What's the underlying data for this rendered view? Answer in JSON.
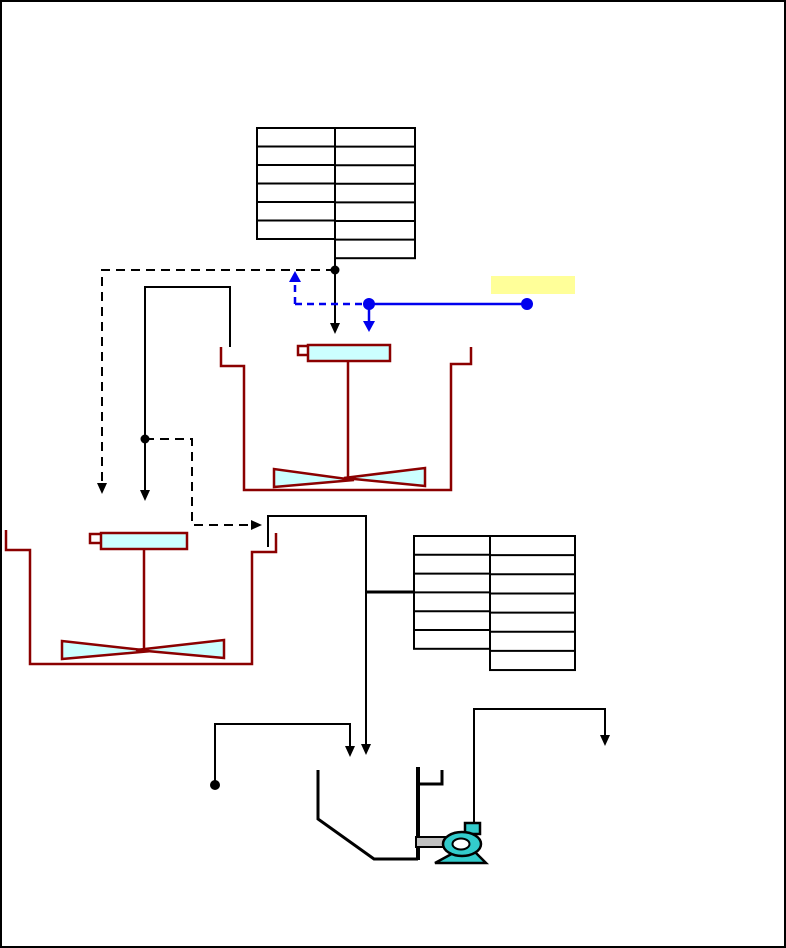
{
  "diagram": {
    "kind": "process-flow-diagram",
    "background": "#FFFFFF",
    "frame_color": "#000000"
  },
  "colors": {
    "line": "#000000",
    "tank_outline": "#8B0000",
    "equipment_fill": "#CCFFFF",
    "pump_fill": "#33CCCC",
    "pipe_gray": "#C0C0C0",
    "signal_blue": "#0000EE",
    "highlight_yellow": "#FFFF99",
    "background": "#FFFFFF"
  },
  "tables": {
    "top_table": {
      "columns": [
        {
          "x": 255,
          "y": 126,
          "width": 78,
          "row_height": 18.5,
          "rows": 6
        },
        {
          "x": 333,
          "y": 126,
          "width": 80,
          "row_height": 18.6,
          "rows": 7
        }
      ],
      "cell_text": ""
    },
    "right_table": {
      "columns": [
        {
          "x": 412,
          "y": 534,
          "width": 76,
          "row_height": 18.8,
          "rows": 6
        },
        {
          "x": 488,
          "y": 534,
          "width": 85,
          "row_height": 19.15,
          "rows": 7
        }
      ],
      "cell_text": ""
    }
  },
  "highlight_box": {
    "text": ""
  },
  "components": [
    "feed-table",
    "data-table",
    "mixing-tank-1",
    "mixing-tank-2",
    "transfer-pipe-1",
    "transfer-pipe-2",
    "recycle-dashed-line",
    "control-dashed-branch",
    "blue-signal-line",
    "highlight-box",
    "sample-line",
    "collection-hopper",
    "pump-suction-pipe",
    "centrifugal-pump",
    "pump-discharge-line"
  ]
}
